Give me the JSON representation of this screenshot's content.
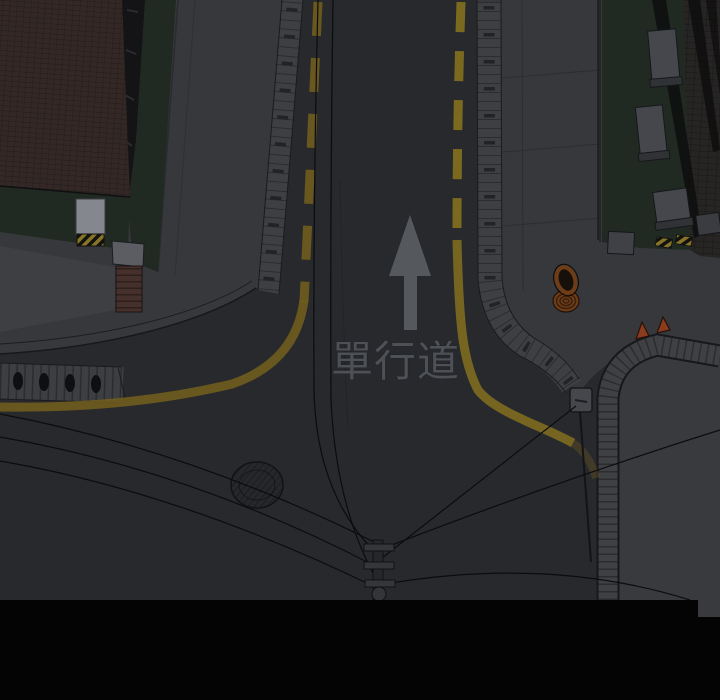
{
  "scene_title": "night top-down street corner",
  "road_markings": {
    "one_way_text": "單行道",
    "arrow_icon": "up-arrow"
  },
  "objects": {
    "manhole": "manhole-cover",
    "utility_pole": "utility-pole-with-wires",
    "coil": "coiled-hose",
    "cones": "traffic-cones",
    "bollards": "sidewalk-bollards"
  },
  "colors": {
    "road": "#28292d",
    "black_band": "#040404",
    "sidewalk": "#37383c",
    "sidewalk_light": "#3e3f43",
    "lot": "#393a3e",
    "green": "#202a23",
    "roof_brick": "#342826",
    "balcony_dark": "#141416",
    "pillar_light": "#84878d",
    "brick_red": "#46302b",
    "brick_cap": "#5b5d62",
    "strip": "#3e3f43",
    "yellow_line": "#6f5c1d",
    "yellow_bright": "#84701f",
    "arrow": "#55585d",
    "marking_text": "#4d5156",
    "hazard_yellow": "#877428",
    "cone": "#8a3c1d",
    "coil": "#6e3d18",
    "coil_dark": "#3a1f0c",
    "manhole": "#25272b",
    "wire": "#0b0c0e",
    "building": "#272523",
    "box_gray": "#45474c",
    "curb_line": "#17181a"
  }
}
